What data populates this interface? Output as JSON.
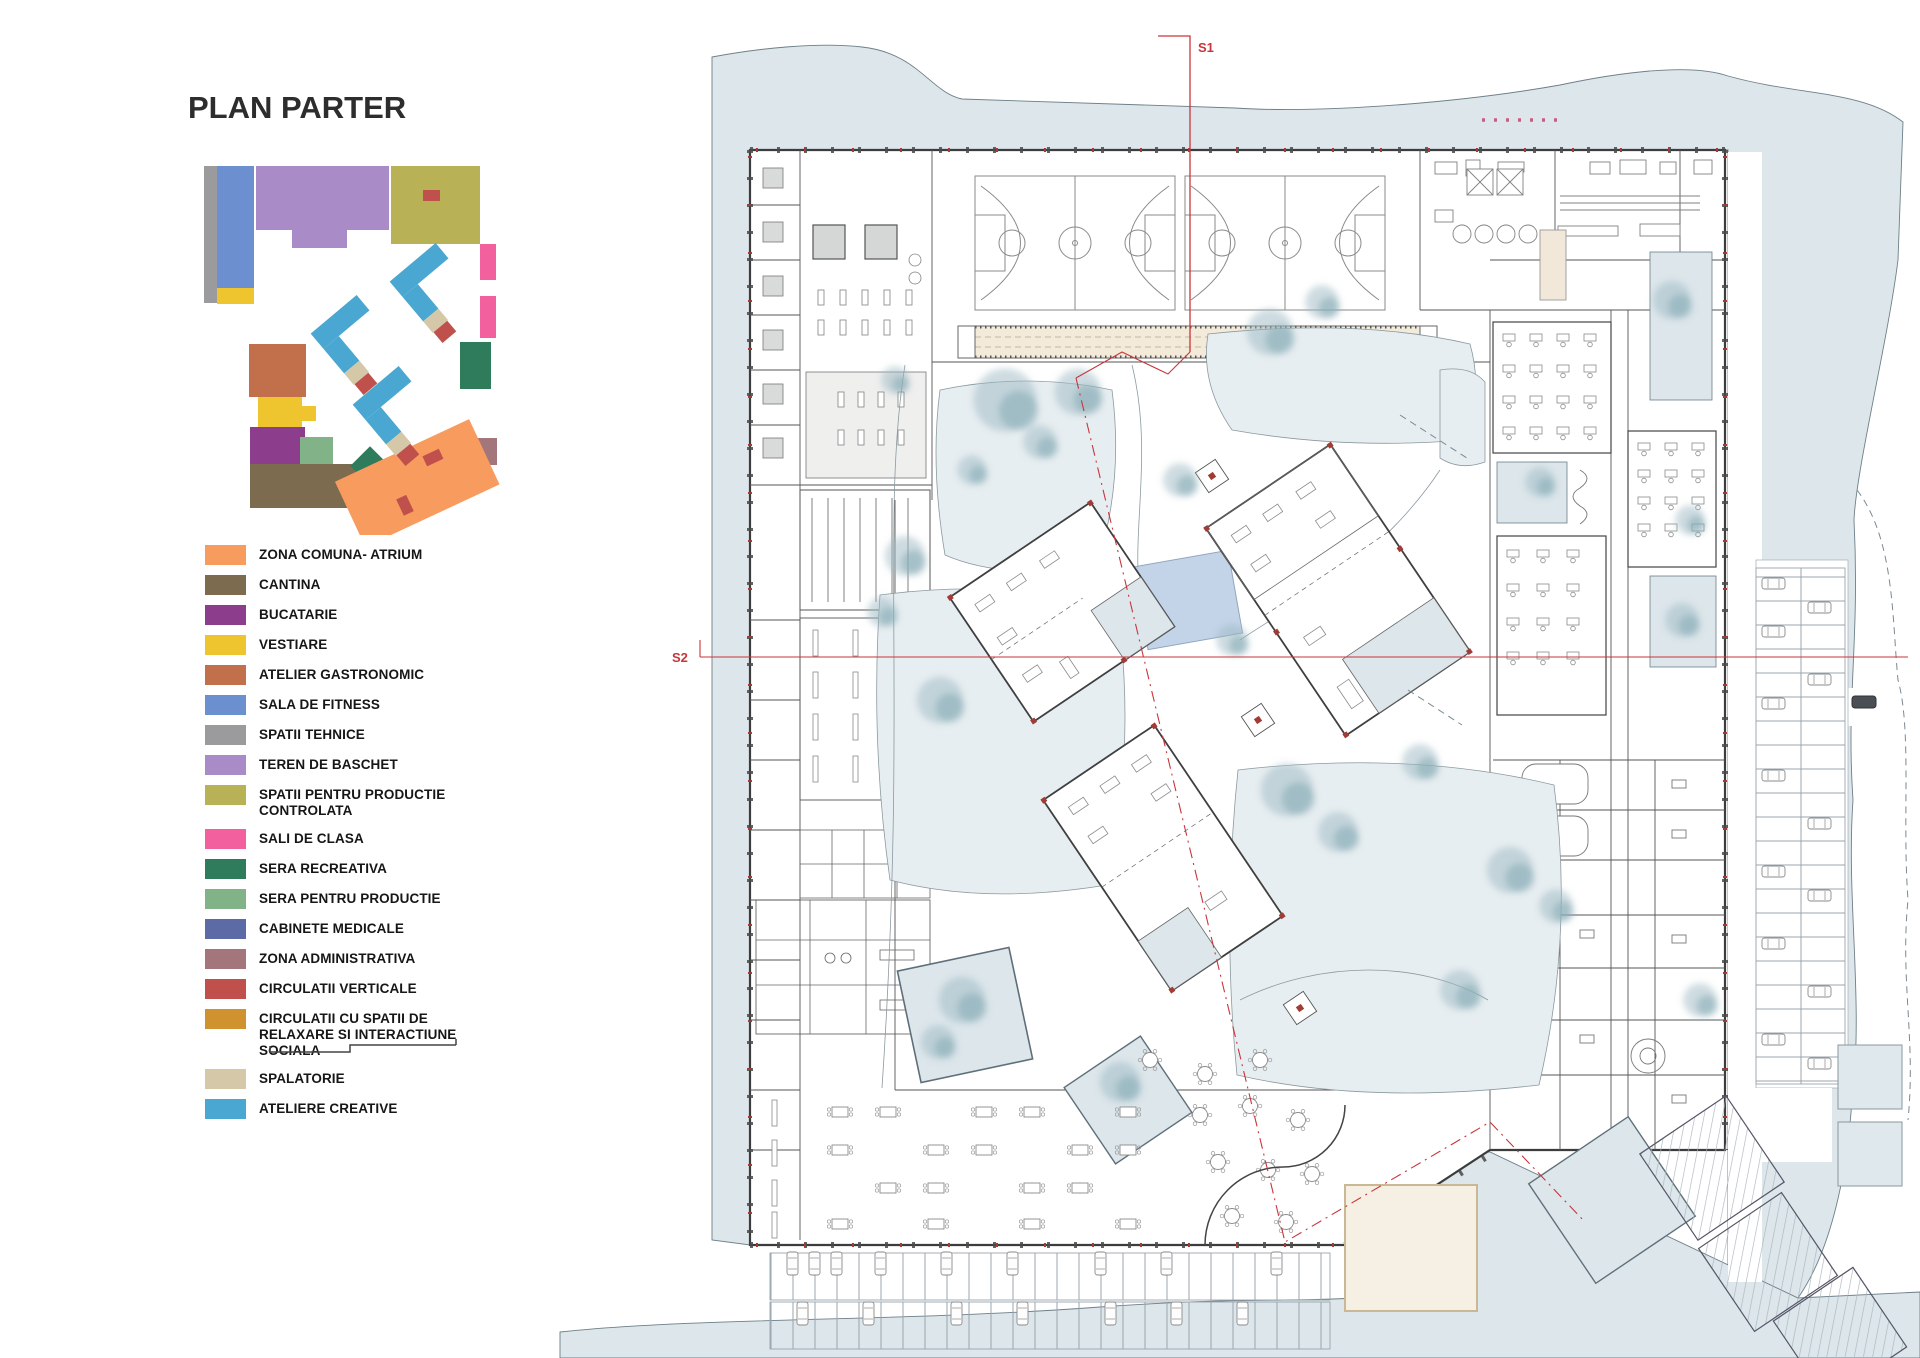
{
  "title": "PLAN PARTER",
  "legend": {
    "items": [
      {
        "label": "ZONA COMUNA- ATRIUM",
        "color": "#F89B5F"
      },
      {
        "label": "CANTINA",
        "color": "#7D6B50"
      },
      {
        "label": "BUCATARIE",
        "color": "#8C3D8C"
      },
      {
        "label": "VESTIARE",
        "color": "#EEC52F"
      },
      {
        "label": "ATELIER GASTRONOMIC",
        "color": "#C2704C"
      },
      {
        "label": "SALA DE FITNESS",
        "color": "#6C90CF"
      },
      {
        "label": "SPATII TEHNICE",
        "color": "#9B9A9D"
      },
      {
        "label": "TEREN DE BASCHET",
        "color": "#A98BC8"
      },
      {
        "label": "SPATII PENTRU PRODUCTIE CONTROLATA",
        "color": "#B8B156"
      },
      {
        "label": "SALI DE CLASA",
        "color": "#F2619D"
      },
      {
        "label": "SERA RECREATIVA",
        "color": "#2F7C5C"
      },
      {
        "label": "SERA PENTRU PRODUCTIE",
        "color": "#82B287"
      },
      {
        "label": "CABINETE MEDICALE",
        "color": "#5C6AA5"
      },
      {
        "label": "ZONA ADMINISTRATIVA",
        "color": "#A3767B"
      },
      {
        "label": "CIRCULATII VERTICALE",
        "color": "#C0504B"
      },
      {
        "label": "CIRCULATII CU SPATII DE RELAXARE SI INTERACTIUNE SOCIALA",
        "color": "#D0922F"
      },
      {
        "label": "SPALATORIE",
        "color": "#D5C8A8"
      },
      {
        "label": "ATELIERE CREATIVE",
        "color": "#49A7D1"
      }
    ]
  },
  "plan": {
    "section_labels": [
      "S1",
      "S2"
    ]
  }
}
